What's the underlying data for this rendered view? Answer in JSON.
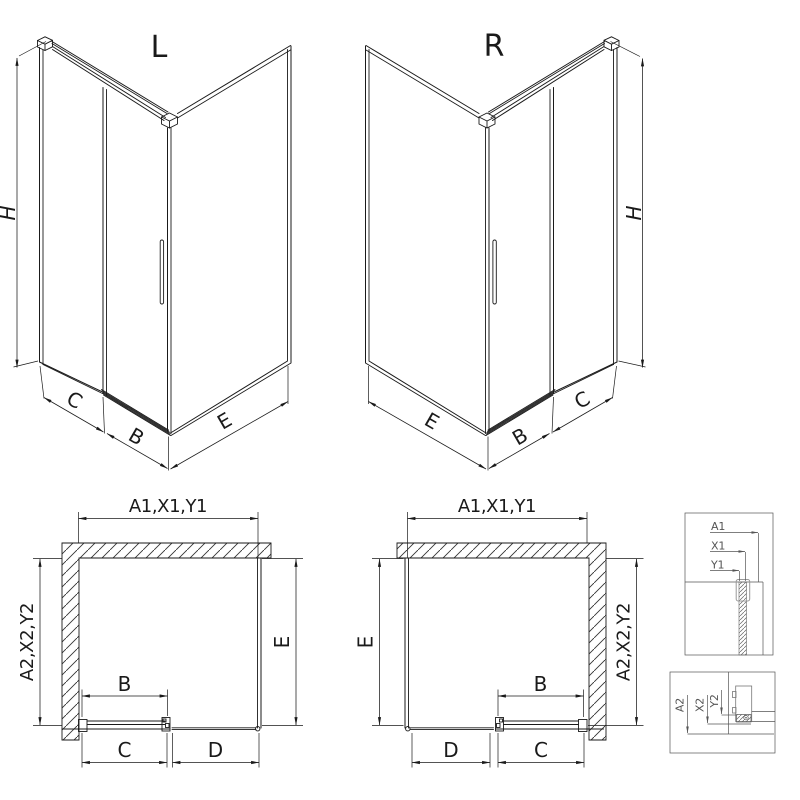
{
  "views": {
    "iso_l": {
      "title": "L",
      "h": "H",
      "c": "C",
      "b": "B",
      "e": "E"
    },
    "iso_r": {
      "title": "R",
      "h": "H",
      "c": "C",
      "b": "B",
      "e": "E"
    },
    "plan_l": {
      "top": "A1,X1,Y1",
      "left": "A2,X2,Y2",
      "right": "E",
      "b": "B",
      "c": "C",
      "d": "D"
    },
    "plan_r": {
      "top": "A1,X1,Y1",
      "left": "E",
      "right": "A2,X2,Y2",
      "b": "B",
      "c": "C",
      "d": "D"
    },
    "detail_top": {
      "a": "A1",
      "x": "X1",
      "y": "Y1"
    },
    "detail_bottom": {
      "a": "A2",
      "x": "X2",
      "y": "Y2"
    }
  },
  "colors": {
    "line": "#1a1a1a",
    "detail_line": "#555555",
    "profile": "#999999",
    "background": "#ffffff"
  }
}
